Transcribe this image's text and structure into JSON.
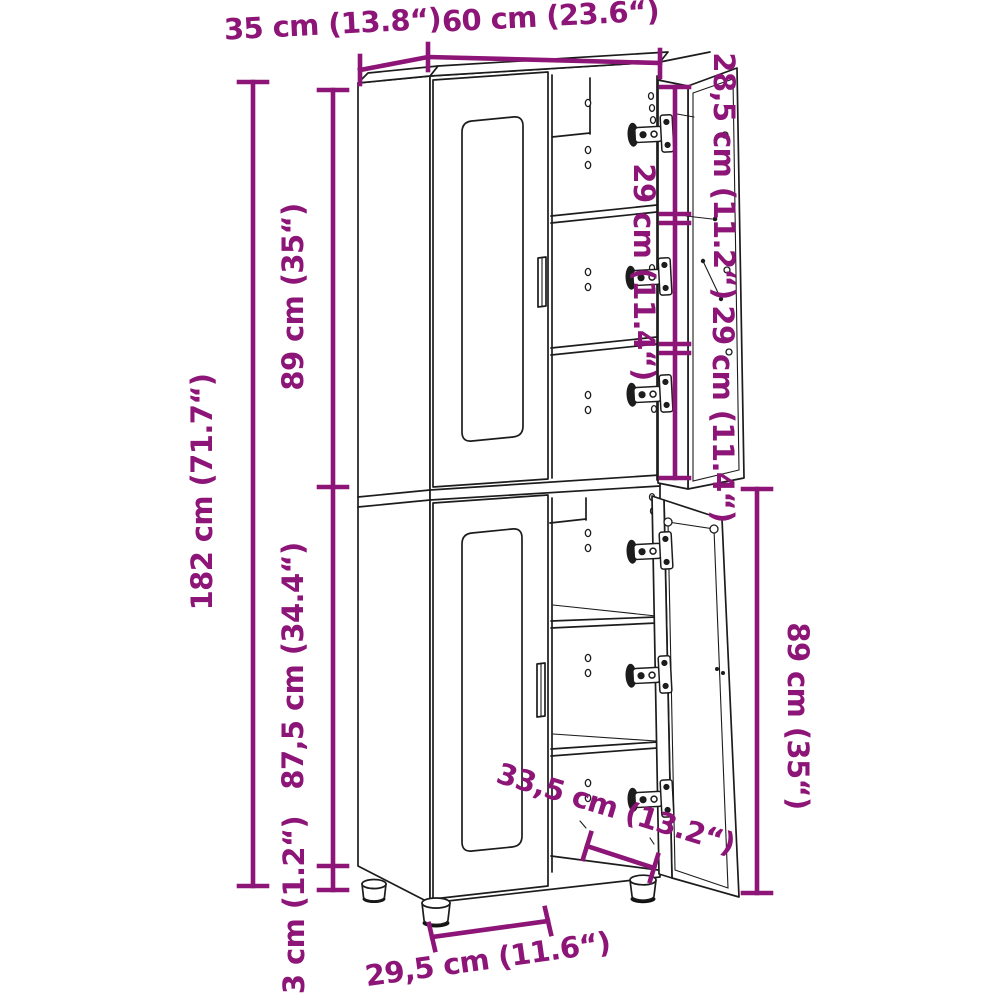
{
  "diagram": {
    "subject": "Tall two-section cabinet with glass-front closed doors and two open right-hand doors, technical line drawing with dimension annotations",
    "colors": {
      "dimension_accent": "#8C1577",
      "drawing_line": "#1c1c1c",
      "background": "#ffffff"
    },
    "labels": {
      "depth_top": "35 cm (13.8“)",
      "width_top": "60 cm (23.6“)",
      "top_compartment_height": "28,5 cm (11.2“)",
      "middle_compartment_height": "29 cm (11.4“)",
      "bottom_compartment_height": "29 cm (11.4“)",
      "upper_section_height": "89 cm (35“)",
      "total_height": "182 cm (71.7“)",
      "lower_section_height": "87,5 cm (34.4“)",
      "feet_height": "3 cm (1.2“)",
      "lower_door_height": "89 cm (35“)",
      "door_width": "33,5 cm (13.2“)",
      "feet_span": "29,5 cm (11.6“)"
    }
  }
}
